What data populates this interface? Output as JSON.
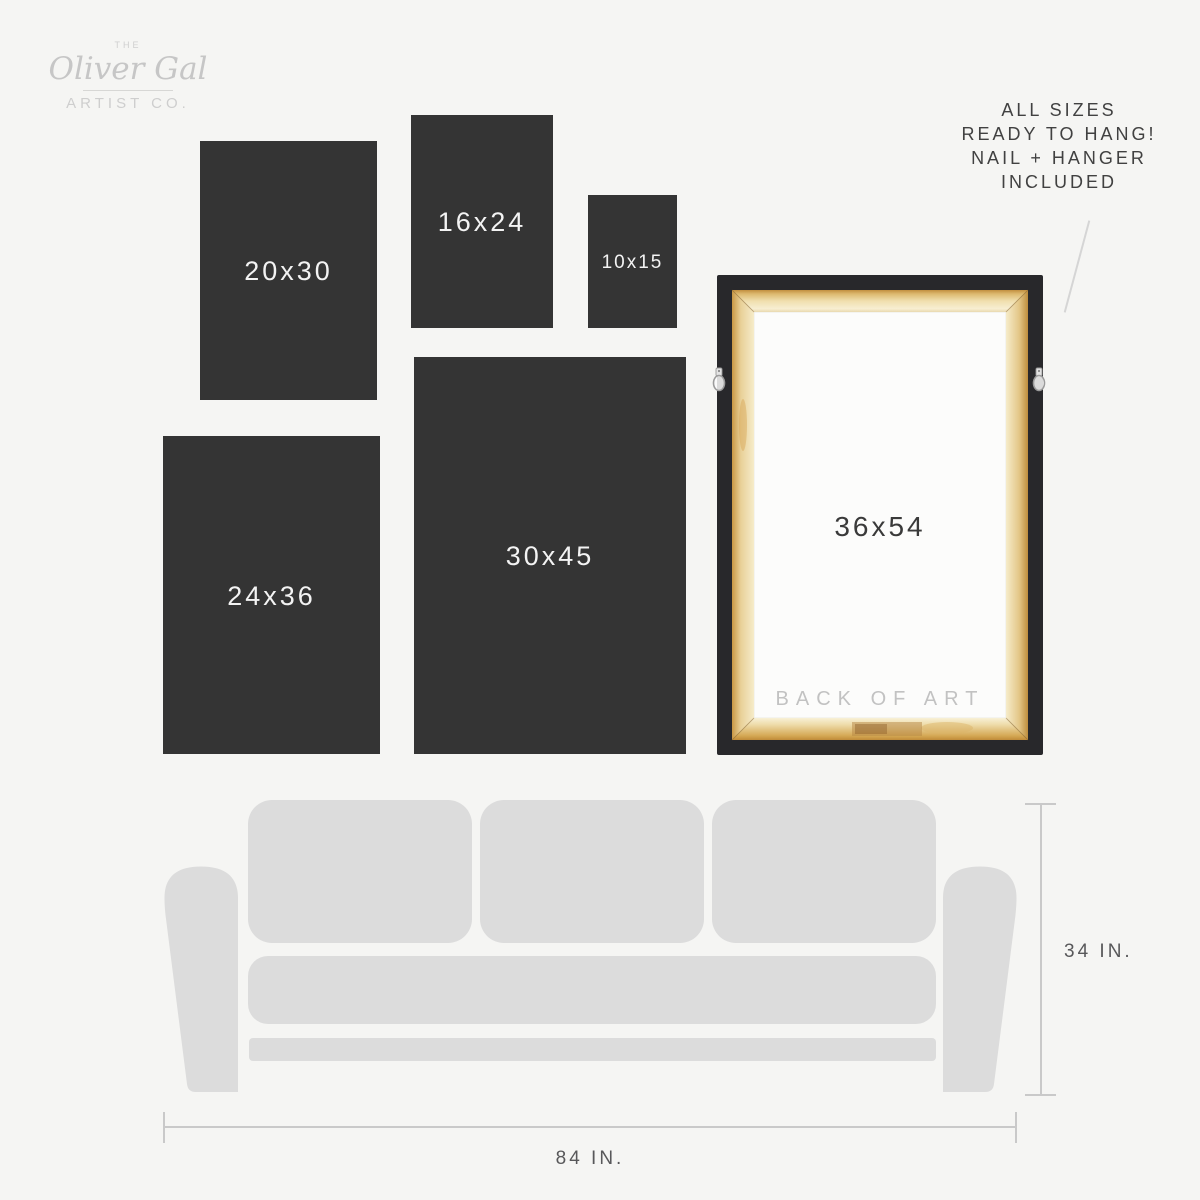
{
  "logo": {
    "the": "THE",
    "name": "Oliver Gal",
    "subtitle": "ARTIST CO."
  },
  "note": {
    "line1": "ALL SIZES",
    "line2": "READY TO HANG!",
    "line3": "NAIL + HANGER",
    "line4": "INCLUDED"
  },
  "sizes": {
    "s2030": "20x30",
    "s1624": "16x24",
    "s1015": "10x15",
    "s2436": "24x36",
    "s3045": "30x45"
  },
  "frame": {
    "size": "36x54",
    "back": "BACK OF ART"
  },
  "dimensions": {
    "height": "34 IN.",
    "width": "84 IN."
  },
  "colors": {
    "background": "#f5f5f3",
    "size_box": "#343434",
    "size_box_text": "#f3f3f3",
    "frame_black": "#28282b",
    "wood_light": "#f4e8c6",
    "wood_dark": "#c89744",
    "canvas_back": "#fcfcfb",
    "couch": "#dcdcdc",
    "dimension_line": "#c9c9c9",
    "note_text": "#414141",
    "logo_gray": "#c9c9c9"
  }
}
